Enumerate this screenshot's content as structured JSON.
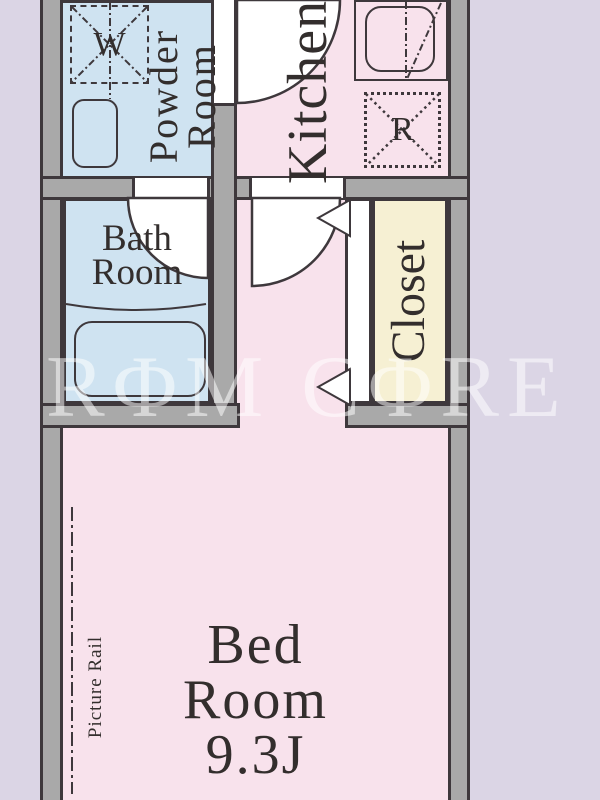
{
  "floor_plan": {
    "rooms": {
      "powder_room": {
        "line1": "Powder",
        "line2": "Room"
      },
      "kitchen": {
        "label": "Kitchen"
      },
      "bath_room": {
        "line1": "Bath",
        "line2": "Room"
      },
      "closet": {
        "label": "Closet"
      },
      "bed_room": {
        "line1": "Bed",
        "line2": "Room",
        "size": "9.3J"
      }
    },
    "symbols": {
      "washing_machine": "W",
      "refrigerator": "R"
    },
    "annotations": {
      "picture_rail": "Picture Rail"
    },
    "watermark": "RΦM CΦRE",
    "colors": {
      "background": "#dbd5e5",
      "wall_fill": "#a9a9a9",
      "outline": "#3e383c",
      "wet_area_fill": "#cfe3f1",
      "living_area_fill": "#f8e2ec",
      "closet_fill": "#f6f0d3",
      "label_text": "#332e2d",
      "watermark_text": "rgba(255,255,255,0.52)"
    }
  }
}
